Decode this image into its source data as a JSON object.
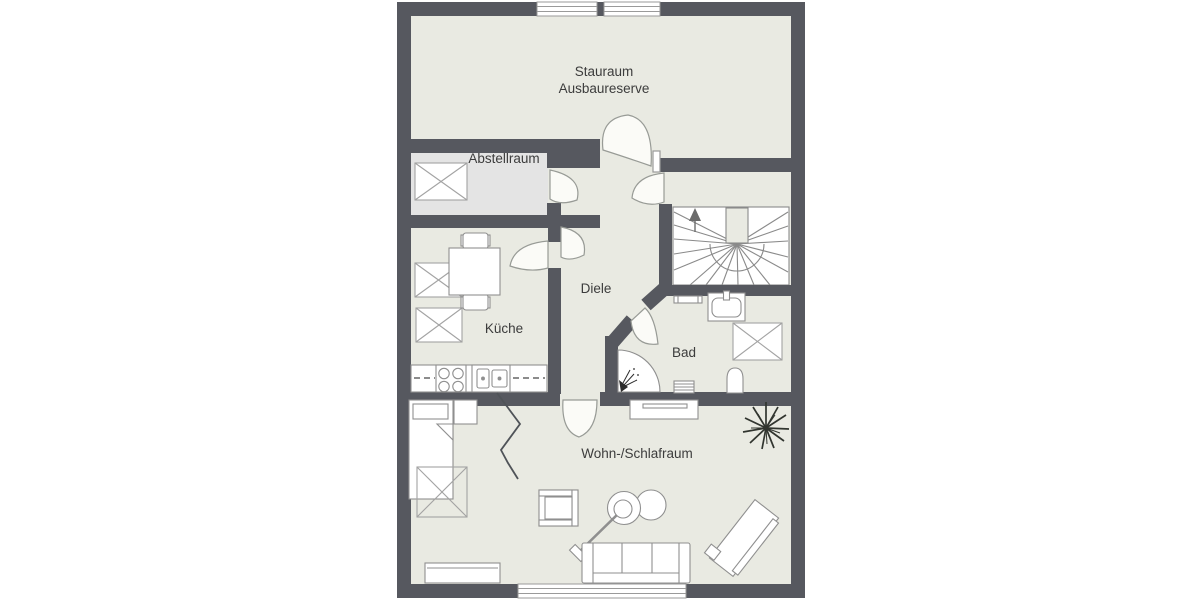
{
  "floorplan": {
    "rooms": {
      "stauraum": {
        "line1": "Stauraum",
        "line2": "Ausbaureserve"
      },
      "abstellraum": {
        "label": "Abstellraum"
      },
      "diele": {
        "label": "Diele"
      },
      "kueche": {
        "label": "Küche"
      },
      "bad": {
        "label": "Bad"
      },
      "wohnschlafraum": {
        "label": "Wohn-/Schlafraum"
      }
    },
    "colors": {
      "wall": "#56585f",
      "floor": "#e9eae2",
      "storage_floor": "#e4e4e4",
      "stair_fill": "#ffffff",
      "furniture_stroke": "#8f8f8f",
      "label_text": "#3c3c3c",
      "background": "#ffffff"
    },
    "symbols": [
      "roof-window",
      "door-swing",
      "winder-staircase",
      "stair-up-arrow",
      "bed",
      "nightstand",
      "kitchen-table",
      "chair",
      "kitchen-counter",
      "stove",
      "sink",
      "shower",
      "toilet",
      "washbasin",
      "radiator",
      "towel-radiator",
      "sideboard",
      "armchair",
      "floor-lamp",
      "sofa",
      "chaise-longue",
      "plant",
      "window"
    ]
  }
}
